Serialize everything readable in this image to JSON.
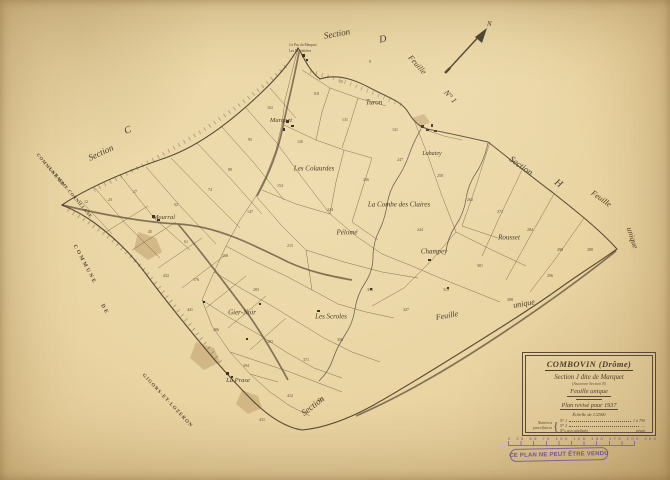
{
  "colors": {
    "paper": "#e9d4a2",
    "line": "#55452f",
    "stamp_purple": "#6d4f9e"
  },
  "compass": {
    "label": "N"
  },
  "stamp": {
    "text": "CE PLAN NE PEUT ÊTRE VENDU"
  },
  "scalebar": {
    "numbers": "0   25   50   75   100   125   150   175   200   250"
  },
  "cartouche": {
    "title": "COMBOVIN (Drôme)",
    "section_line": "Section J dite de Marquet",
    "ancienne": "(Ancienne Section N)",
    "feuille": "Feuille unique",
    "revision": "Plan revisé pour 1937",
    "scale": "Échelle de 1/2500",
    "table": {
      "left1": "Numéros",
      "left2": "parcellaires",
      "brace": "{",
      "rows": [
        {
          "label": "N° 1",
          "value": "1 à 790"
        },
        {
          "label": "N° 2",
          "value": "—"
        },
        {
          "label": "N°s non attribués",
          "value": "néant"
        }
      ]
    }
  },
  "map_labels": [
    {
      "name": "label-section-d",
      "text": "Section",
      "x": 337,
      "y": 34,
      "rot": -10,
      "size": 9
    },
    {
      "name": "label-section-d-letter",
      "text": "D",
      "x": 383,
      "y": 40,
      "rot": -10,
      "size": 10
    },
    {
      "name": "label-feuille-ne",
      "text": "Feuille",
      "x": 417,
      "y": 65,
      "rot": 48,
      "size": 8
    },
    {
      "name": "label-sheet-no1",
      "text": "N° 1",
      "x": 450,
      "y": 97,
      "rot": 48,
      "size": 8
    },
    {
      "name": "label-section-c",
      "text": "Section",
      "x": 101,
      "y": 153,
      "rot": -25,
      "size": 9
    },
    {
      "name": "label-section-c-letter",
      "text": "C",
      "x": 128,
      "y": 131,
      "rot": -25,
      "size": 10
    },
    {
      "name": "label-commune-de-nw",
      "text": "COMMUNE DE",
      "x": 50,
      "y": 170,
      "rot": 50,
      "size": 4.6,
      "ls": 0.8,
      "cls": "caps"
    },
    {
      "name": "label-la-baume-cornillane",
      "text": "LA BAUME-CORNILLANE",
      "x": 70,
      "y": 193,
      "rot": 50,
      "size": 4.6,
      "ls": 0.4,
      "cls": "caps"
    },
    {
      "name": "label-commune-w",
      "text": "COMMUNE",
      "x": 84,
      "y": 265,
      "rot": 62,
      "size": 5.5,
      "ls": 2,
      "cls": "caps"
    },
    {
      "name": "label-de-w",
      "text": "DE",
      "x": 104,
      "y": 310,
      "rot": 62,
      "size": 5.5,
      "ls": 2,
      "cls": "caps"
    },
    {
      "name": "label-gigors-et-lozeron",
      "text": "GIGORS-ET-LOZERON",
      "x": 167,
      "y": 401,
      "rot": 47,
      "size": 5,
      "ls": 1,
      "cls": "caps"
    },
    {
      "name": "label-section-s",
      "text": "Section",
      "x": 313,
      "y": 406,
      "rot": -38,
      "size": 9
    },
    {
      "name": "label-section-h",
      "text": "Section",
      "x": 521,
      "y": 166,
      "rot": 36,
      "size": 9
    },
    {
      "name": "label-section-h-letter",
      "text": "H",
      "x": 558,
      "y": 184,
      "rot": 36,
      "size": 10
    },
    {
      "name": "label-feuille-e",
      "text": "Feuille",
      "x": 601,
      "y": 199,
      "rot": 36,
      "size": 8
    },
    {
      "name": "label-unique-e",
      "text": "unique",
      "x": 632,
      "y": 238,
      "rot": 72,
      "size": 8
    },
    {
      "name": "label-feuille-se",
      "text": "Feuille",
      "x": 447,
      "y": 316,
      "rot": -10,
      "size": 8
    },
    {
      "name": "label-unique-se",
      "text": "unique",
      "x": 524,
      "y": 304,
      "rot": -10,
      "size": 8
    },
    {
      "name": "label-marquet",
      "text": "Marquet",
      "x": 281,
      "y": 121,
      "rot": 0,
      "size": 6.5
    },
    {
      "name": "label-turon",
      "text": "Turon",
      "x": 374,
      "y": 103,
      "rot": 0,
      "size": 7
    },
    {
      "name": "label-lobatey",
      "text": "Lobatey",
      "x": 432,
      "y": 154,
      "rot": 0,
      "size": 6
    },
    {
      "name": "label-les-colaurdes",
      "text": "Les Colaurdes",
      "x": 314,
      "y": 169,
      "rot": 0,
      "size": 7
    },
    {
      "name": "label-la-combe-des-claires",
      "text": "La Combe des Claires",
      "x": 399,
      "y": 205,
      "rot": 0,
      "size": 7
    },
    {
      "name": "label-pelome",
      "text": "Pélomé",
      "x": 347,
      "y": 233,
      "rot": 0,
      "size": 7
    },
    {
      "name": "label-champey",
      "text": "Champey",
      "x": 434,
      "y": 252,
      "rot": 0,
      "size": 7
    },
    {
      "name": "label-rousset",
      "text": "Rousset",
      "x": 509,
      "y": 238,
      "rot": 0,
      "size": 7
    },
    {
      "name": "label-mourral",
      "text": "Mourral",
      "x": 164,
      "y": 218,
      "rot": 0,
      "size": 6.5
    },
    {
      "name": "label-gier-noir",
      "text": "Gier-Noir",
      "x": 242,
      "y": 313,
      "rot": 0,
      "size": 7
    },
    {
      "name": "label-les-scroles",
      "text": "Les Scroles",
      "x": 331,
      "y": 317,
      "rot": 0,
      "size": 7
    },
    {
      "name": "label-la-prase",
      "text": "La Prase",
      "x": 238,
      "y": 381,
      "rot": 0,
      "size": 6.5
    },
    {
      "name": "label-le-pas-du-marquet",
      "text": "Le Pas du Marquet",
      "x": 303,
      "y": 46,
      "rot": 0,
      "size": 3.6,
      "cls": "tiny"
    },
    {
      "name": "label-les-bouchieres",
      "text": "Les Bouchières",
      "x": 300,
      "y": 52,
      "rot": 0,
      "size": 3.6,
      "cls": "tiny"
    }
  ],
  "parcel_numbers": [
    {
      "x": 110,
      "y": 200,
      "v": "23"
    },
    {
      "x": 135,
      "y": 192,
      "v": "27"
    },
    {
      "x": 150,
      "y": 232,
      "v": "45"
    },
    {
      "x": 176,
      "y": 205,
      "v": "52"
    },
    {
      "x": 186,
      "y": 242,
      "v": "61"
    },
    {
      "x": 210,
      "y": 190,
      "v": "74"
    },
    {
      "x": 230,
      "y": 170,
      "v": "88"
    },
    {
      "x": 250,
      "y": 140,
      "v": "95"
    },
    {
      "x": 270,
      "y": 108,
      "v": "102"
    },
    {
      "x": 316,
      "y": 94,
      "v": "118"
    },
    {
      "x": 345,
      "y": 120,
      "v": "131"
    },
    {
      "x": 300,
      "y": 142,
      "v": "126"
    },
    {
      "x": 280,
      "y": 186,
      "v": "154"
    },
    {
      "x": 250,
      "y": 212,
      "v": "147"
    },
    {
      "x": 225,
      "y": 256,
      "v": "168"
    },
    {
      "x": 196,
      "y": 280,
      "v": "176"
    },
    {
      "x": 256,
      "y": 290,
      "v": "203"
    },
    {
      "x": 290,
      "y": 246,
      "v": "215"
    },
    {
      "x": 330,
      "y": 210,
      "v": "224"
    },
    {
      "x": 366,
      "y": 180,
      "v": "236"
    },
    {
      "x": 400,
      "y": 160,
      "v": "247"
    },
    {
      "x": 440,
      "y": 176,
      "v": "258"
    },
    {
      "x": 470,
      "y": 200,
      "v": "262"
    },
    {
      "x": 500,
      "y": 212,
      "v": "271"
    },
    {
      "x": 530,
      "y": 230,
      "v": "284"
    },
    {
      "x": 560,
      "y": 250,
      "v": "290"
    },
    {
      "x": 480,
      "y": 266,
      "v": "301"
    },
    {
      "x": 446,
      "y": 290,
      "v": "315"
    },
    {
      "x": 406,
      "y": 310,
      "v": "327"
    },
    {
      "x": 370,
      "y": 290,
      "v": "334"
    },
    {
      "x": 340,
      "y": 340,
      "v": "356"
    },
    {
      "x": 306,
      "y": 360,
      "v": "371"
    },
    {
      "x": 270,
      "y": 342,
      "v": "382"
    },
    {
      "x": 246,
      "y": 366,
      "v": "394"
    },
    {
      "x": 216,
      "y": 330,
      "v": "406"
    },
    {
      "x": 290,
      "y": 396,
      "v": "412"
    },
    {
      "x": 320,
      "y": 400,
      "v": "423"
    },
    {
      "x": 262,
      "y": 420,
      "v": "431"
    },
    {
      "x": 190,
      "y": 310,
      "v": "441"
    },
    {
      "x": 166,
      "y": 276,
      "v": "452"
    },
    {
      "x": 86,
      "y": 202,
      "v": "12"
    },
    {
      "x": 370,
      "y": 62,
      "v": "9"
    },
    {
      "x": 341,
      "y": 82,
      "v": "15"
    },
    {
      "x": 395,
      "y": 130,
      "v": "141"
    },
    {
      "x": 420,
      "y": 230,
      "v": "244"
    },
    {
      "x": 510,
      "y": 300,
      "v": "308"
    },
    {
      "x": 550,
      "y": 276,
      "v": "296"
    },
    {
      "x": 590,
      "y": 250,
      "v": "288"
    }
  ]
}
